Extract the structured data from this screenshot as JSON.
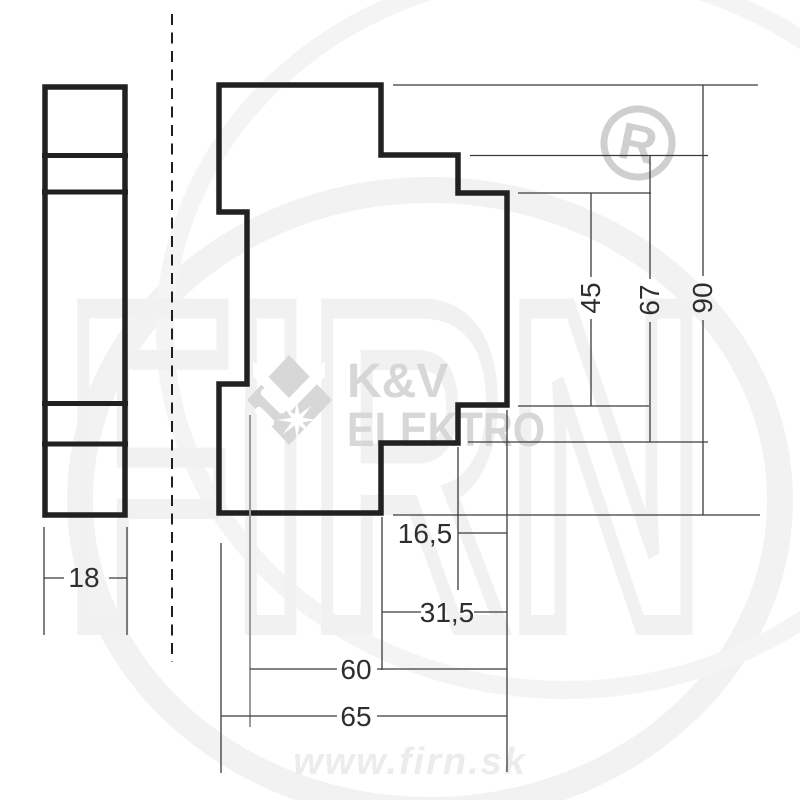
{
  "drawing_type": "technical-dimension-drawing",
  "dimensions": {
    "width_18": "18",
    "depth_16_5": "16,5",
    "depth_31_5": "31,5",
    "depth_60": "60",
    "depth_65": "65",
    "height_45": "45",
    "height_67": "67",
    "height_90": "90"
  },
  "watermark": {
    "brand_line1": "K&V",
    "brand_line2": "ELEKTRO",
    "registered_mark": "R",
    "url": "www.firn.sk",
    "background_text": "FIRN"
  },
  "colors": {
    "outline": "#212121",
    "dimension_lines": "#3b3b3b",
    "label_text": "#2e2e2e",
    "watermark_brand": "#d7d7d7",
    "watermark_url": "#ececec",
    "watermark_faint": "#f1f1f1"
  }
}
